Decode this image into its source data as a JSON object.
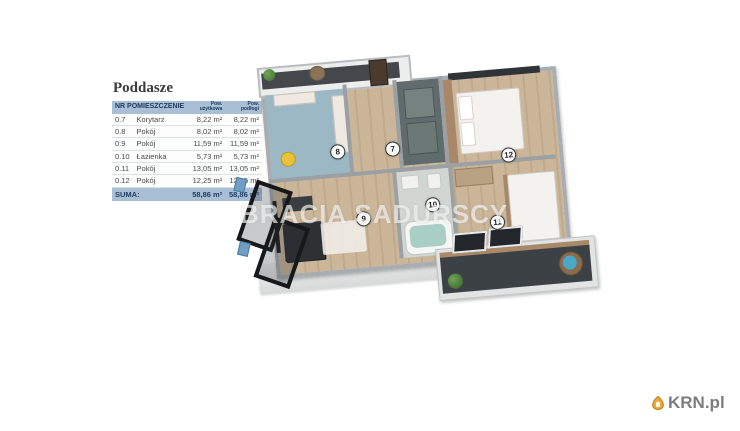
{
  "legend": {
    "title": "Poddasze",
    "table": {
      "header_rooms": "NR POMIESZCZENIE",
      "header_area1_line1": "Pow.",
      "header_area1_line2": "użytkowa",
      "header_area2_line1": "Pow.",
      "header_area2_line2": "podłogi",
      "header_bg": "#a9bfd6",
      "rows": [
        {
          "nr": "0.7",
          "name": "Korytarz",
          "area1": "8,22 m²",
          "area2": "8,22 m²"
        },
        {
          "nr": "0.8",
          "name": "Pokój",
          "area1": "8,02 m²",
          "area2": "8,02 m²"
        },
        {
          "nr": "0.9",
          "name": "Pokój",
          "area1": "11,59 m²",
          "area2": "11,59 m²"
        },
        {
          "nr": "0.10",
          "name": "Łazienka",
          "area1": "5,73 m²",
          "area2": "5,73 m²"
        },
        {
          "nr": "0.11",
          "name": "Pokój",
          "area1": "13,05 m²",
          "area2": "13,05 m²"
        },
        {
          "nr": "0.12",
          "name": "Pokój",
          "area1": "12,25 m²",
          "area2": "12,25 m²"
        }
      ],
      "suma_label": "SUMA:",
      "suma_area1": "58,86 m²",
      "suma_area2": "58,86 m²"
    }
  },
  "floorplan": {
    "badges": [
      "7",
      "8",
      "9",
      "10",
      "11",
      "12"
    ],
    "colors": {
      "wood_floor": "#c9b499",
      "room8_floor": "#9db8c5",
      "bath_floor": "#d2d6d3",
      "balcony_floor": "#3c4145",
      "wall": "#9aa0a3",
      "tub_water": "#a9cfc4"
    }
  },
  "watermark": {
    "text": "BRACIA SADURSCY"
  },
  "logo": {
    "text": "KRN.pl",
    "icon": "house-icon",
    "accent": "#e89c1e"
  }
}
